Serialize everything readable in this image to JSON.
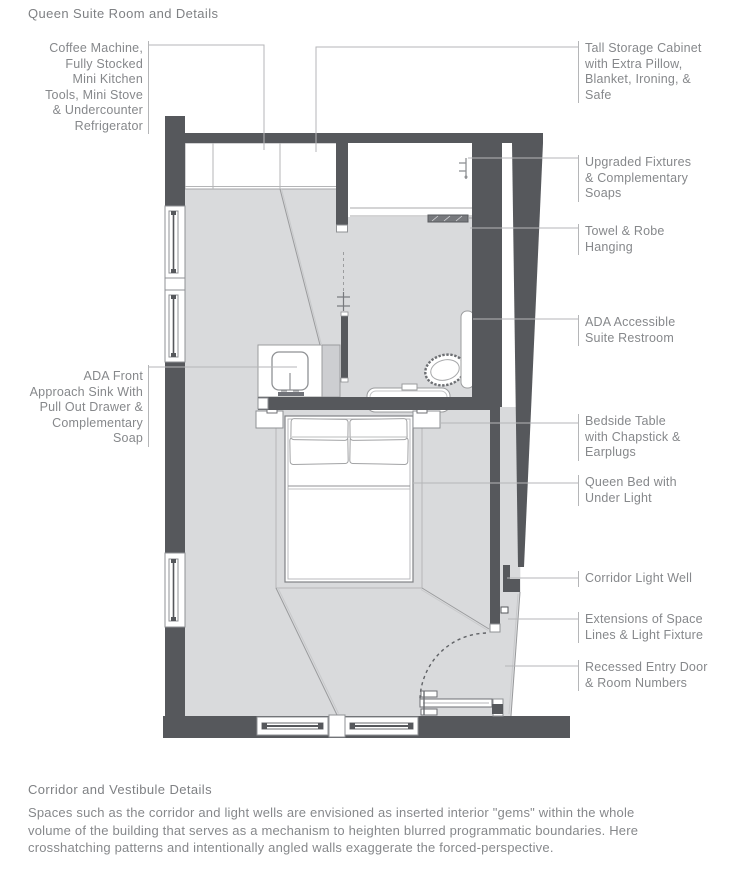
{
  "title": "Queen Suite Room and Details",
  "labels_left": [
    {
      "text": "Coffee Machine,\nFully Stocked\nMini Kitchen\nTools, Mini Stove\n& Undercounter\nRefrigerator"
    },
    {
      "text": "ADA Front\nApproach Sink With\nPull Out Drawer &\nComplementary\nSoap"
    }
  ],
  "labels_right": [
    {
      "text": "Tall Storage Cabinet\nwith Extra Pillow,\nBlanket, Ironing, &\nSafe"
    },
    {
      "text": "Upgraded Fixtures\n& Complementary\nSoaps"
    },
    {
      "text": "Towel & Robe\nHanging"
    },
    {
      "text": "ADA Accessible\nSuite Restroom"
    },
    {
      "text": "Bedside Table\nwith Chapstick &\nEarplugs"
    },
    {
      "text": "Queen Bed with\nUnder Light"
    },
    {
      "text": "Corridor Light Well"
    },
    {
      "text": "Extensions of Space\nLines & Light Fixture"
    },
    {
      "text": "Recessed Entry Door\n& Room Numbers"
    }
  ],
  "footer": {
    "heading": "Corridor and Vestibule Details",
    "body": "Spaces such as the corridor and light wells are envisioned as inserted interior \"gems\" within the whole\nvolume of the building that serves as a mechanism to heighten blurred programmatic boundaries. Here\ncrosshatching patterns and intentionally angled walls exaggerate the forced-perspective."
  },
  "colors": {
    "wall": "#56585c",
    "floor": "#d9dadc",
    "fixture_outline": "#9b9c9e",
    "leader_line": "#b5b6b8",
    "text": "#85878a"
  }
}
